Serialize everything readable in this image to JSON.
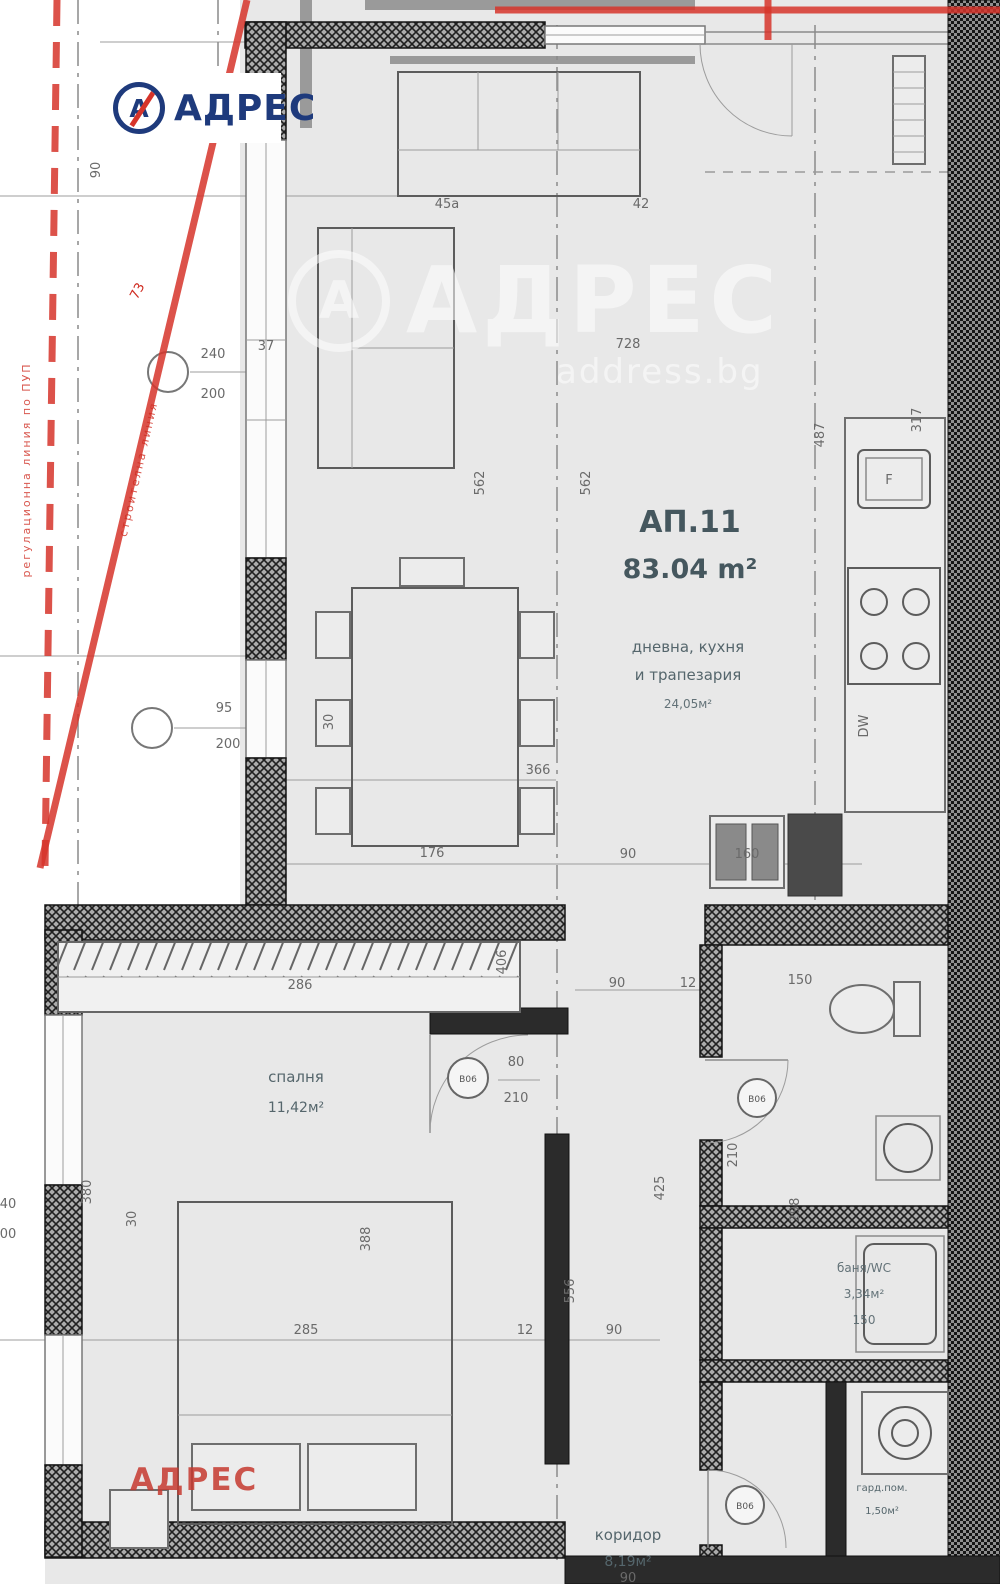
{
  "colors": {
    "accent_red": "#d6342a",
    "brand_navy": "#1e3a7c",
    "plan_gray": "#e8e8e8",
    "wall_dark": "#1c1c1c",
    "dim_gray": "#6a6a6a",
    "room_text": "#55666c",
    "watermark_white": "#ffffff"
  },
  "branding": {
    "logo": {
      "mark": "А",
      "text": "АДРЕС"
    },
    "watermark": {
      "mark": "А",
      "text": "АДРЕС",
      "sub": "address.bg"
    },
    "red_watermark": "АДРЕС"
  },
  "apartment": {
    "id": "АП.11",
    "area": "83.04 m²"
  },
  "rooms": {
    "living": {
      "line1": "дневна, кухня",
      "line2": "и трапезария",
      "area": "24,05м²"
    },
    "bedroom": {
      "name": "спалня",
      "area": "11,42м²"
    },
    "bath": {
      "name": "баня/WC",
      "area": "3,34м²",
      "width": "150"
    },
    "corridor": {
      "name": "коридор",
      "area": "8,19м²"
    },
    "storage": {
      "name": "гард.пом.",
      "area": "1,50м²"
    }
  },
  "fixtures": {
    "sink_label": "F",
    "dishwasher_label": "DW"
  },
  "door_circles": [
    {
      "label": "В06"
    },
    {
      "label": "В06"
    },
    {
      "label": "В06"
    }
  ],
  "boundary": {
    "line1": "регулационна линия по ПУП",
    "line2": "строителна линия"
  },
  "dims": [
    {
      "t": "90",
      "x": 100,
      "y": 170,
      "r": -90
    },
    {
      "t": "73",
      "x": 141,
      "y": 293,
      "r": -62,
      "c": "red",
      "s": 14
    },
    {
      "t": "240",
      "x": 213,
      "y": 358
    },
    {
      "t": "200",
      "x": 213,
      "y": 398
    },
    {
      "t": "37",
      "x": 266,
      "y": 350
    },
    {
      "t": "95",
      "x": 224,
      "y": 712,
      "s": 11
    },
    {
      "t": "200",
      "x": 228,
      "y": 748
    },
    {
      "t": "30",
      "x": 333,
      "y": 722,
      "r": -90
    },
    {
      "t": "728",
      "x": 628,
      "y": 348
    },
    {
      "t": "562",
      "x": 484,
      "y": 483,
      "r": -90
    },
    {
      "t": "562",
      "x": 590,
      "y": 483,
      "r": -90
    },
    {
      "t": "487",
      "x": 824,
      "y": 435,
      "r": -90
    },
    {
      "t": "317",
      "x": 921,
      "y": 420,
      "r": -90
    },
    {
      "t": "366",
      "x": 538,
      "y": 774
    },
    {
      "t": "176",
      "x": 432,
      "y": 857
    },
    {
      "t": "90",
      "x": 628,
      "y": 858
    },
    {
      "t": "160",
      "x": 747,
      "y": 858
    },
    {
      "t": "286",
      "x": 300,
      "y": 989
    },
    {
      "t": "406",
      "x": 506,
      "y": 962,
      "r": -90,
      "s": 11
    },
    {
      "t": "90",
      "x": 617,
      "y": 987
    },
    {
      "t": "12",
      "x": 688,
      "y": 987
    },
    {
      "t": "150",
      "x": 800,
      "y": 984,
      "s": 11
    },
    {
      "t": "80",
      "x": 516,
      "y": 1066
    },
    {
      "t": "210",
      "x": 516,
      "y": 1102
    },
    {
      "t": "380",
      "x": 91,
      "y": 1192,
      "r": -90
    },
    {
      "t": "30",
      "x": 136,
      "y": 1219,
      "r": -90
    },
    {
      "t": "388",
      "x": 370,
      "y": 1239,
      "r": -90
    },
    {
      "t": "40",
      "x": 8,
      "y": 1208
    },
    {
      "t": "00",
      "x": 8,
      "y": 1238
    },
    {
      "t": "285",
      "x": 306,
      "y": 1334
    },
    {
      "t": "12",
      "x": 525,
      "y": 1334
    },
    {
      "t": "90",
      "x": 614,
      "y": 1334
    },
    {
      "t": "556",
      "x": 574,
      "y": 1291,
      "r": -90
    },
    {
      "t": "425",
      "x": 664,
      "y": 1188,
      "r": -90
    },
    {
      "t": "210",
      "x": 737,
      "y": 1155,
      "r": -90,
      "s": 11
    },
    {
      "t": "298",
      "x": 799,
      "y": 1210,
      "r": -90,
      "s": 11
    },
    {
      "t": "90",
      "x": 628,
      "y": 1582
    },
    {
      "t": "45а",
      "x": 447,
      "y": 208,
      "s": 10
    },
    {
      "t": "42",
      "x": 641,
      "y": 208,
      "s": 10
    }
  ]
}
